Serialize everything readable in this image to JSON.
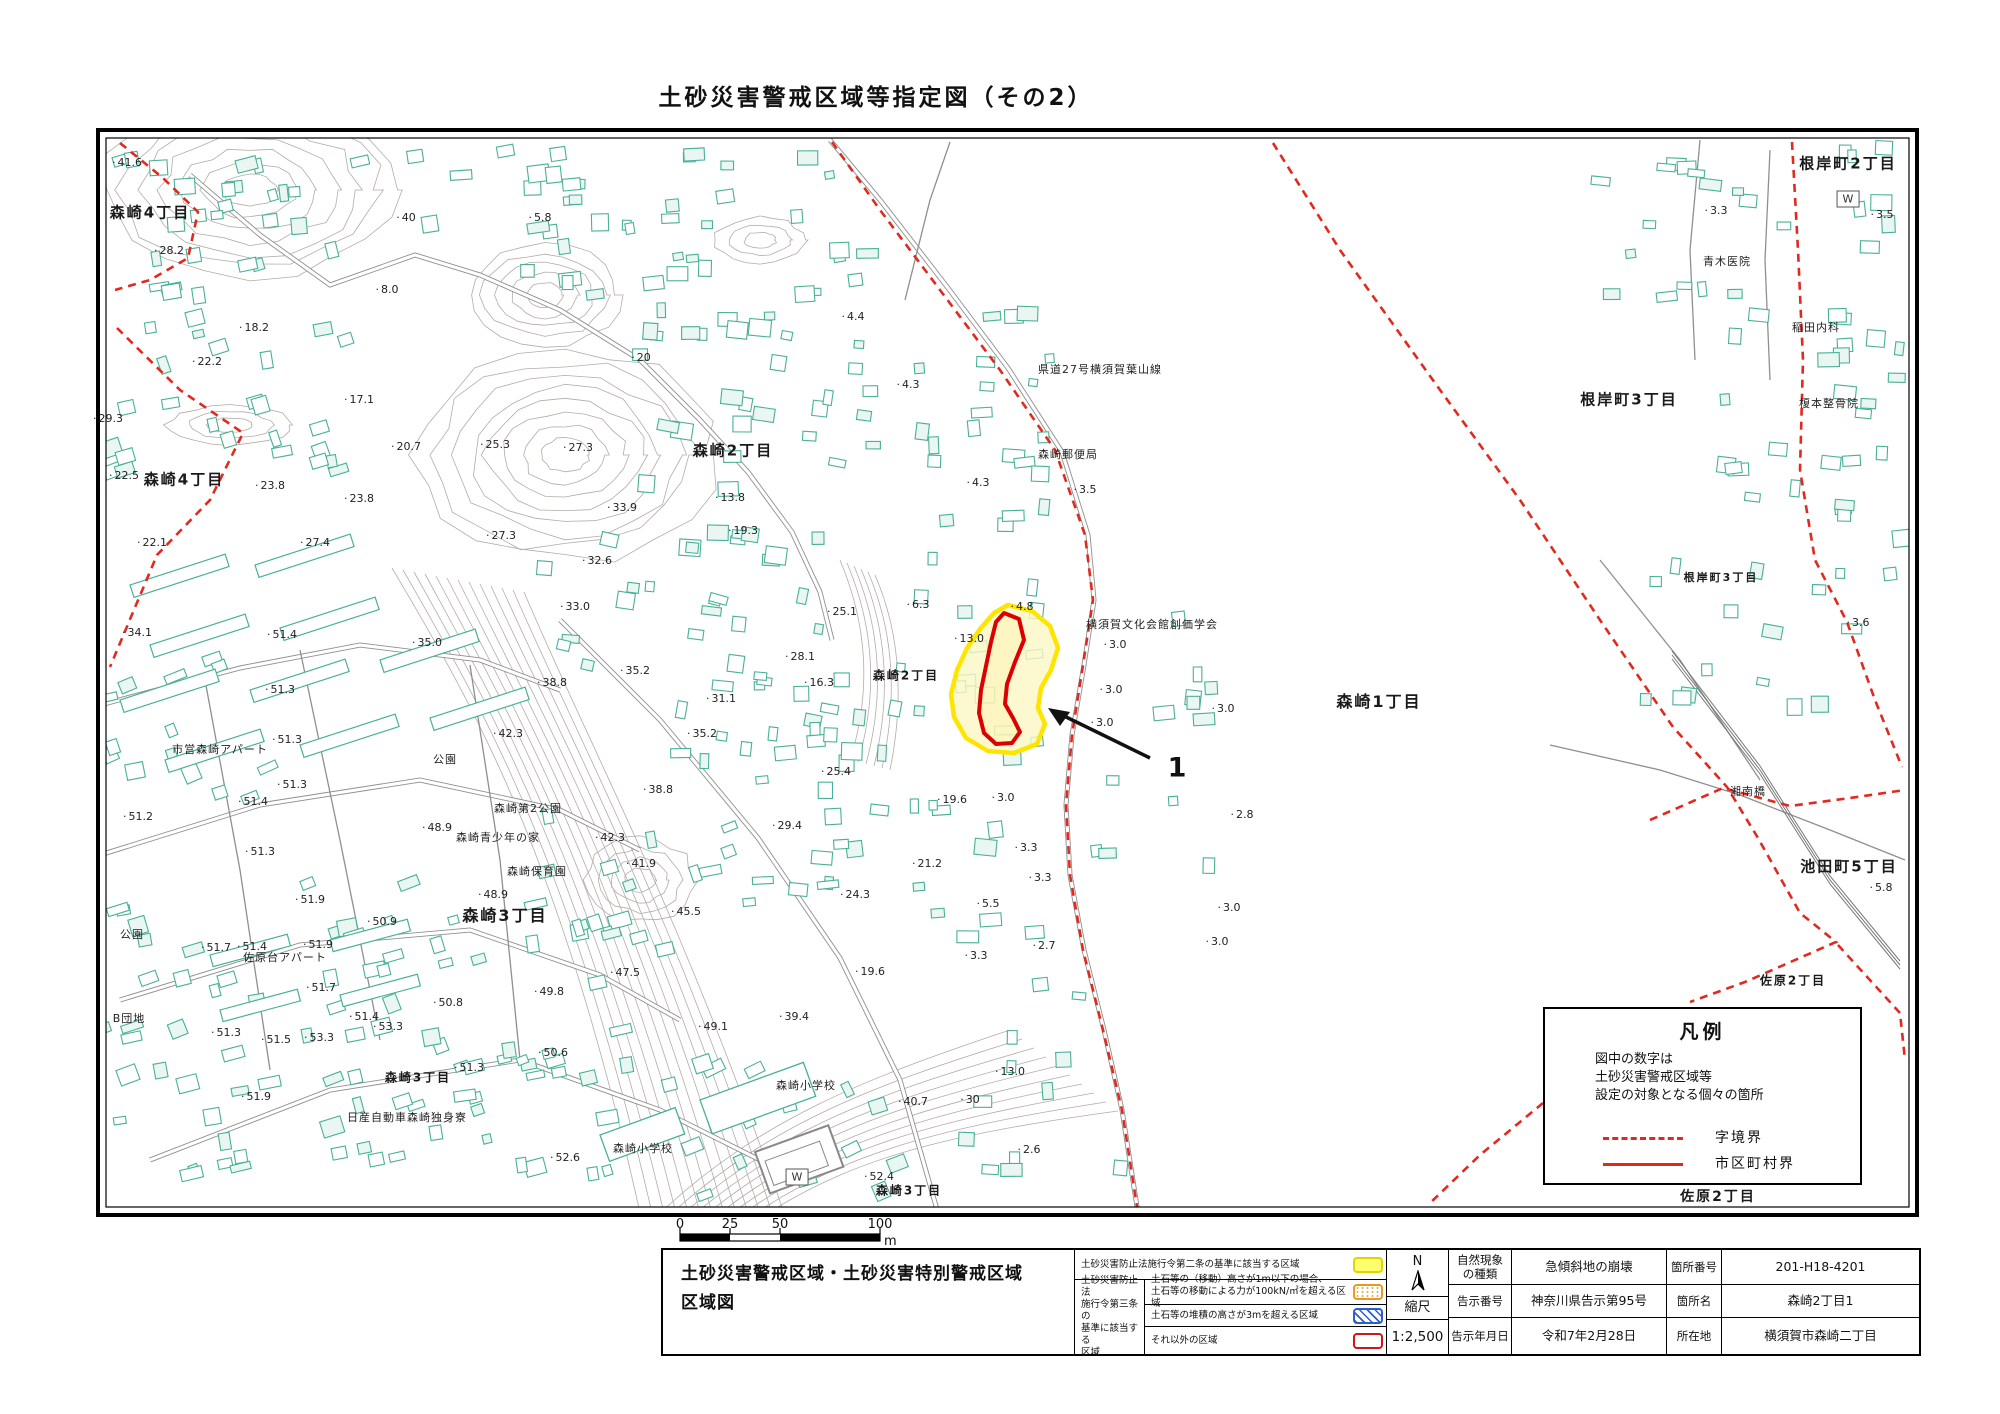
{
  "title": "土砂災害警戒区域等指定図（その2）",
  "colors": {
    "zone_yellow": "#ffe400",
    "zone_yellow_fill": "#fbf7c4",
    "zone_red": "#dd0000",
    "boundary_red": "#e02a20",
    "building_teal": "#49b098",
    "contour_gray": "#b3aca6",
    "road_gray": "#8f8f8f",
    "swatch_yellow": "#ffff6e",
    "swatch_orange": "#e8991e",
    "swatch_blue": "#2b5fd0",
    "swatch_red": "#d01616"
  },
  "map": {
    "w_symbol_label": "W",
    "w_symbols": [
      {
        "x": 1848,
        "y": 199
      },
      {
        "x": 797,
        "y": 1177
      }
    ],
    "hazard_point_label": "1",
    "area_labels": [
      {
        "t": "森崎4丁目",
        "x": 150,
        "y": 213,
        "s": 15
      },
      {
        "t": "森崎4丁目",
        "x": 184,
        "y": 480,
        "s": 15
      },
      {
        "t": "森崎2丁目",
        "x": 733,
        "y": 451,
        "s": 15
      },
      {
        "t": "森崎2丁目",
        "x": 906,
        "y": 676,
        "s": 12
      },
      {
        "t": "森崎1丁目",
        "x": 1379,
        "y": 701,
        "s": 16
      },
      {
        "t": "森崎3丁目",
        "x": 505,
        "y": 915,
        "s": 16
      },
      {
        "t": "森崎3丁目",
        "x": 418,
        "y": 1078,
        "s": 12
      },
      {
        "t": "森崎3丁目",
        "x": 909,
        "y": 1191,
        "s": 12
      },
      {
        "t": "根岸町2丁目",
        "x": 1848,
        "y": 164,
        "s": 15
      },
      {
        "t": "根岸町3丁目",
        "x": 1629,
        "y": 400,
        "s": 15
      },
      {
        "t": "根岸町3丁目",
        "x": 1721,
        "y": 578,
        "s": 11
      },
      {
        "t": "池田町5丁目",
        "x": 1849,
        "y": 867,
        "s": 15
      },
      {
        "t": "佐原2丁目",
        "x": 1793,
        "y": 981,
        "s": 12
      },
      {
        "t": "佐原2丁目",
        "x": 1718,
        "y": 1197,
        "s": 14
      }
    ],
    "facility_labels": [
      {
        "t": "県道27号横須賀葉山線",
        "x": 1100,
        "y": 370,
        "s": 11
      },
      {
        "t": "森崎郵便局",
        "x": 1068,
        "y": 455,
        "s": 11
      },
      {
        "t": "横須賀文化会館創価学会",
        "x": 1152,
        "y": 625,
        "s": 11
      },
      {
        "t": "青木医院",
        "x": 1727,
        "y": 262,
        "s": 11
      },
      {
        "t": "稲田内科",
        "x": 1816,
        "y": 328,
        "s": 11
      },
      {
        "t": "榎本整骨院",
        "x": 1829,
        "y": 404,
        "s": 11
      },
      {
        "t": "市営森崎アパート",
        "x": 220,
        "y": 750,
        "s": 11
      },
      {
        "t": "公園",
        "x": 445,
        "y": 760,
        "s": 11
      },
      {
        "t": "公園",
        "x": 132,
        "y": 935,
        "s": 11
      },
      {
        "t": "森崎第2公園",
        "x": 528,
        "y": 809,
        "s": 11
      },
      {
        "t": "森崎青少年の家",
        "x": 498,
        "y": 838,
        "s": 11
      },
      {
        "t": "森崎保育園",
        "x": 537,
        "y": 872,
        "s": 11
      },
      {
        "t": "佐原台アパート",
        "x": 285,
        "y": 958,
        "s": 11
      },
      {
        "t": "B団地",
        "x": 129,
        "y": 1019,
        "s": 11
      },
      {
        "t": "日産自動車森崎独身寮",
        "x": 407,
        "y": 1118,
        "s": 11
      },
      {
        "t": "森崎小学校",
        "x": 806,
        "y": 1086,
        "s": 11
      },
      {
        "t": "森崎小学校",
        "x": 643,
        "y": 1149,
        "s": 11
      },
      {
        "t": "湘南橋",
        "x": 1748,
        "y": 792,
        "s": 11
      }
    ],
    "spot_heights": [
      {
        "v": "41.6",
        "x": 127,
        "y": 163
      },
      {
        "v": "28.2",
        "x": 169,
        "y": 251
      },
      {
        "v": "40",
        "x": 406,
        "y": 218
      },
      {
        "v": "5.8",
        "x": 540,
        "y": 218
      },
      {
        "v": "8.0",
        "x": 387,
        "y": 290
      },
      {
        "v": "18.2",
        "x": 254,
        "y": 328
      },
      {
        "v": "22.2",
        "x": 207,
        "y": 362
      },
      {
        "v": "29.3",
        "x": 108,
        "y": 419
      },
      {
        "v": "17.1",
        "x": 359,
        "y": 400
      },
      {
        "v": "20.7",
        "x": 406,
        "y": 447
      },
      {
        "v": "25.3",
        "x": 495,
        "y": 445
      },
      {
        "v": "27.3",
        "x": 578,
        "y": 448
      },
      {
        "v": "20",
        "x": 641,
        "y": 358
      },
      {
        "v": "13.8",
        "x": 730,
        "y": 498
      },
      {
        "v": "22.5",
        "x": 124,
        "y": 476
      },
      {
        "v": "23.8",
        "x": 270,
        "y": 486
      },
      {
        "v": "23.8",
        "x": 359,
        "y": 499
      },
      {
        "v": "33.9",
        "x": 622,
        "y": 508
      },
      {
        "v": "22.1",
        "x": 152,
        "y": 543
      },
      {
        "v": "27.4",
        "x": 315,
        "y": 543
      },
      {
        "v": "27.3",
        "x": 501,
        "y": 536
      },
      {
        "v": "32.6",
        "x": 597,
        "y": 561
      },
      {
        "v": "4.4",
        "x": 853,
        "y": 317
      },
      {
        "v": "4.3",
        "x": 908,
        "y": 385
      },
      {
        "v": "4.3",
        "x": 978,
        "y": 483
      },
      {
        "v": "3.5",
        "x": 1085,
        "y": 490
      },
      {
        "v": "19.3",
        "x": 743,
        "y": 531
      },
      {
        "v": "33.0",
        "x": 575,
        "y": 607
      },
      {
        "v": "25.1",
        "x": 842,
        "y": 612
      },
      {
        "v": "6.3",
        "x": 918,
        "y": 605
      },
      {
        "v": "4.8",
        "x": 1022,
        "y": 607
      },
      {
        "v": "13.0",
        "x": 969,
        "y": 639
      },
      {
        "v": "3.0",
        "x": 1115,
        "y": 645
      },
      {
        "v": "34.1",
        "x": 137,
        "y": 633
      },
      {
        "v": "51.4",
        "x": 282,
        "y": 635
      },
      {
        "v": "35.0",
        "x": 427,
        "y": 643
      },
      {
        "v": "28.1",
        "x": 800,
        "y": 657
      },
      {
        "v": "16.3",
        "x": 819,
        "y": 683
      },
      {
        "v": "3.0",
        "x": 1111,
        "y": 690
      },
      {
        "v": "3.0",
        "x": 1223,
        "y": 709
      },
      {
        "v": "3.0",
        "x": 1102,
        "y": 723
      },
      {
        "v": "31.1",
        "x": 721,
        "y": 699
      },
      {
        "v": "51.3",
        "x": 280,
        "y": 690
      },
      {
        "v": "38.8",
        "x": 552,
        "y": 683
      },
      {
        "v": "35.2",
        "x": 635,
        "y": 671
      },
      {
        "v": "42.3",
        "x": 508,
        "y": 734
      },
      {
        "v": "35.2",
        "x": 702,
        "y": 734
      },
      {
        "v": "25.4",
        "x": 836,
        "y": 772
      },
      {
        "v": "38.8",
        "x": 658,
        "y": 790
      },
      {
        "v": "19.6",
        "x": 952,
        "y": 800
      },
      {
        "v": "2.8",
        "x": 1242,
        "y": 815
      },
      {
        "v": "29.4",
        "x": 787,
        "y": 826
      },
      {
        "v": "3.3",
        "x": 1026,
        "y": 848
      },
      {
        "v": "3.3",
        "x": 1040,
        "y": 878
      },
      {
        "v": "21.2",
        "x": 927,
        "y": 864
      },
      {
        "v": "42.3",
        "x": 610,
        "y": 838
      },
      {
        "v": "41.9",
        "x": 641,
        "y": 864
      },
      {
        "v": "24.3",
        "x": 855,
        "y": 895
      },
      {
        "v": "5.5",
        "x": 988,
        "y": 904
      },
      {
        "v": "3.0",
        "x": 1229,
        "y": 908
      },
      {
        "v": "45.5",
        "x": 686,
        "y": 912
      },
      {
        "v": "48.9",
        "x": 437,
        "y": 828
      },
      {
        "v": "48.9",
        "x": 493,
        "y": 895
      },
      {
        "v": "51.4",
        "x": 253,
        "y": 802
      },
      {
        "v": "51.2",
        "x": 138,
        "y": 817
      },
      {
        "v": "51.3",
        "x": 287,
        "y": 740
      },
      {
        "v": "51.3",
        "x": 292,
        "y": 785
      },
      {
        "v": "51.3",
        "x": 260,
        "y": 852
      },
      {
        "v": "51.9",
        "x": 310,
        "y": 900
      },
      {
        "v": "50.9",
        "x": 382,
        "y": 922
      },
      {
        "v": "51.7",
        "x": 216,
        "y": 948
      },
      {
        "v": "51.4",
        "x": 252,
        "y": 947
      },
      {
        "v": "51.9",
        "x": 318,
        "y": 945
      },
      {
        "v": "51.7",
        "x": 321,
        "y": 988
      },
      {
        "v": "50.8",
        "x": 448,
        "y": 1003
      },
      {
        "v": "51.4",
        "x": 364,
        "y": 1017
      },
      {
        "v": "53.3",
        "x": 388,
        "y": 1027
      },
      {
        "v": "51.3",
        "x": 226,
        "y": 1033
      },
      {
        "v": "51.5",
        "x": 276,
        "y": 1040
      },
      {
        "v": "53.3",
        "x": 319,
        "y": 1038
      },
      {
        "v": "51.3",
        "x": 469,
        "y": 1068
      },
      {
        "v": "51.9",
        "x": 256,
        "y": 1097
      },
      {
        "v": "47.5",
        "x": 625,
        "y": 973
      },
      {
        "v": "49.8",
        "x": 549,
        "y": 992
      },
      {
        "v": "49.1",
        "x": 713,
        "y": 1027
      },
      {
        "v": "39.4",
        "x": 794,
        "y": 1017
      },
      {
        "v": "50.6",
        "x": 553,
        "y": 1053
      },
      {
        "v": "19.6",
        "x": 870,
        "y": 972
      },
      {
        "v": "3.0",
        "x": 1003,
        "y": 798
      },
      {
        "v": "3.3",
        "x": 976,
        "y": 956
      },
      {
        "v": "2.7",
        "x": 1044,
        "y": 946
      },
      {
        "v": "3.0",
        "x": 1217,
        "y": 942
      },
      {
        "v": "52.6",
        "x": 565,
        "y": 1158
      },
      {
        "v": "40.7",
        "x": 913,
        "y": 1102
      },
      {
        "v": "30",
        "x": 970,
        "y": 1100
      },
      {
        "v": "13.0",
        "x": 1010,
        "y": 1072
      },
      {
        "v": "52.4",
        "x": 879,
        "y": 1177
      },
      {
        "v": "2.6",
        "x": 1029,
        "y": 1150
      },
      {
        "v": "3.3",
        "x": 1716,
        "y": 211
      },
      {
        "v": "3.5",
        "x": 1882,
        "y": 215
      },
      {
        "v": "3.6",
        "x": 1858,
        "y": 623
      },
      {
        "v": "5.8",
        "x": 1881,
        "y": 888
      }
    ],
    "scale_bar": {
      "ticks": [
        "0",
        "25",
        "50",
        "100"
      ],
      "unit": "m"
    },
    "legend_box": {
      "title": "凡例",
      "note": "図中の数字は\n土砂災害警戒区域等\n設定の対象となる個々の箇所",
      "dashed_label": "字境界",
      "solid_label": "市区町村界"
    }
  },
  "info_table": {
    "doc_title": "土砂災害警戒区域・土砂災害特別警戒区域\n区域図",
    "law_table": {
      "row1": "土砂災害防止法施行令第二条の基準に該当する区域",
      "group_label": "土砂災害防止法\n施行令第三条の\n基準に該当する\n区域",
      "row2": "土石等の（移動）高さが1m以下の場合、\n土石等の移動による力が100kN/㎡を超える区域",
      "row3": "土石等の堆積の高さが3mを超える区域",
      "row4": "それ以外の区域"
    },
    "compass_label": "N",
    "scale_label": "縮尺",
    "scale_value": "1:2,500",
    "fields": [
      {
        "label": "自然現象\nの種類",
        "value": "急傾斜地の崩壊",
        "label2": "箇所番号",
        "value2": "201-H18-4201"
      },
      {
        "label": "告示番号",
        "value": "神奈川県告示第95号",
        "label2": "箇所名",
        "value2": "森崎2丁目1"
      },
      {
        "label": "告示年月日",
        "value": "令和7年2月28日",
        "label2": "所在地",
        "value2": "横須賀市森崎二丁目"
      }
    ]
  }
}
